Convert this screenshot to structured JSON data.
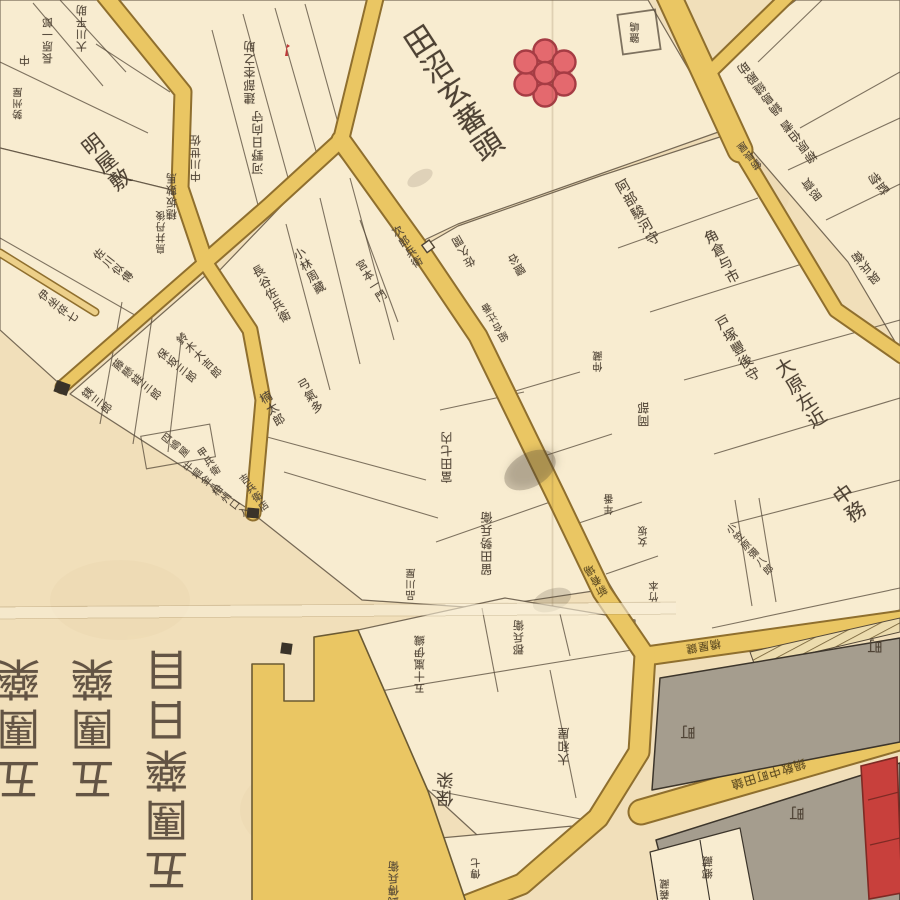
{
  "map": {
    "description": "Edo-period Japanese cadastral block map (kiriezu) with hand-inked parcels, yellow streets, grey townsman blocks and vertical kanji parcel-holder names",
    "palette": {
      "paper": "#f1dfba",
      "parcel": "#f8ecd0",
      "road_fill": "#eac663",
      "road_casing": "#8f6f2e",
      "ink": "#4e4234",
      "street_text": "#5e4b20",
      "gray_block": "#a59d8e",
      "red_mark": "#e4696e",
      "red_building": "#c8403c"
    },
    "marks": [
      {
        "name": "plum-blossom-crest",
        "shape": "seven red circles (one center, six petals)",
        "color": "#e4696e"
      },
      {
        "name": "red-shrine-building",
        "shape": "narrow red rectangle at right edge",
        "color": "#c8403c"
      },
      {
        "name": "guard-post-square",
        "count": 3,
        "color": "#3a3329"
      },
      {
        "name": "road-gate",
        "shape": "small open square on road",
        "color": "#f8ecd0"
      },
      {
        "name": "hatched-bank-strip",
        "shape": "diagonal hatching along street",
        "color": "#6e5a30"
      },
      {
        "name": "small-red-flag",
        "color": "#c03a3a"
      }
    ],
    "big_characters": {
      "note": "large upside-down characters in lower-left blank area",
      "columns": [
        {
          "text": "五團藥",
          "x": 23,
          "y": 727
        },
        {
          "text": "五團藥",
          "x": 97,
          "y": 727
        },
        {
          "text": "五團藥日目",
          "x": 171,
          "y": 768
        }
      ],
      "size": 44,
      "rotation": 180
    },
    "labels": [
      {
        "t": "大川平助",
        "x": 82,
        "y": 28,
        "r": 180,
        "s": 11
      },
      {
        "t": "長原一郎",
        "x": 48,
        "y": 40,
        "r": 180,
        "s": 11
      },
      {
        "t": "中",
        "x": 25,
        "y": 60,
        "r": 180,
        "s": 11
      },
      {
        "t": "勢州屋",
        "x": 20,
        "y": 103,
        "r": 180,
        "s": 10
      },
      {
        "t": "建部杢之助",
        "x": 250,
        "y": 72,
        "r": 180,
        "s": 12
      },
      {
        "t": "河野日向守",
        "x": 258,
        "y": 142,
        "r": 180,
        "s": 12
      },
      {
        "t": "中川世佐",
        "x": 196,
        "y": 158,
        "r": 180,
        "s": 11
      },
      {
        "t": "穗坂數馬",
        "x": 172,
        "y": 196,
        "r": 180,
        "s": 11
      },
      {
        "t": "鳥井丹後",
        "x": 163,
        "y": 232,
        "r": 180,
        "s": 10
      },
      {
        "t": "明屋敷",
        "x": 105,
        "y": 163,
        "r": -38,
        "s": 21
      },
      {
        "t": "佐川似傳",
        "x": 113,
        "y": 266,
        "r": -52,
        "s": 11
      },
      {
        "t": "伊坐倅七",
        "x": 58,
        "y": 307,
        "r": -52,
        "s": 11
      },
      {
        "t": "銕三郎",
        "x": 97,
        "y": 401,
        "r": -52,
        "s": 11
      },
      {
        "t": "藤懸銈三郎",
        "x": 137,
        "y": 380,
        "r": -52,
        "s": 11
      },
      {
        "t": "保坂三郎",
        "x": 177,
        "y": 366,
        "r": -52,
        "s": 11
      },
      {
        "t": "四嶋屋",
        "x": 174,
        "y": 447,
        "r": -52,
        "s": 10
      },
      {
        "t": "牛堀金八",
        "x": 200,
        "y": 479,
        "r": -52,
        "s": 10
      },
      {
        "t": "相州口入",
        "x": 229,
        "y": 503,
        "r": -52,
        "s": 10
      },
      {
        "t": "鈴木大吉郎",
        "x": 199,
        "y": 356,
        "r": -45,
        "s": 11
      },
      {
        "t": "長谷佐兵衛",
        "x": 271,
        "y": 294,
        "r": -30,
        "s": 12
      },
      {
        "t": "小林周藏",
        "x": 309,
        "y": 271,
        "r": -30,
        "s": 12
      },
      {
        "t": "弓氣多",
        "x": 310,
        "y": 396,
        "r": -30,
        "s": 12
      },
      {
        "t": "楠太郎",
        "x": 272,
        "y": 409,
        "r": -30,
        "s": 12
      },
      {
        "t": "甲兵衛",
        "x": 207,
        "y": 463,
        "r": -35,
        "s": 10
      },
      {
        "t": "吉兵衛店",
        "x": 252,
        "y": 494,
        "r": -35,
        "s": 10
      },
      {
        "t": "次郎兵衛",
        "x": 407,
        "y": 247,
        "r": -32,
        "s": 11
      },
      {
        "t": "宮本一門",
        "x": 371,
        "y": 281,
        "r": -32,
        "s": 11
      },
      {
        "t": "田沼玄蕃頭",
        "x": 450,
        "y": 95,
        "r": -33,
        "s": 30
      },
      {
        "t": "鹽嶋",
        "x": 637,
        "y": 32,
        "r": 180,
        "s": 10
      },
      {
        "t": "阿部駿河守",
        "x": 637,
        "y": 213,
        "r": -30,
        "s": 14
      },
      {
        "t": "角倉与市",
        "x": 721,
        "y": 257,
        "r": -28,
        "s": 14
      },
      {
        "t": "戸塚豐後守",
        "x": 737,
        "y": 349,
        "r": -30,
        "s": 14
      },
      {
        "t": "大原左近",
        "x": 799,
        "y": 394,
        "r": -32,
        "s": 19
      },
      {
        "t": "中務",
        "x": 848,
        "y": 504,
        "r": -35,
        "s": 20
      },
      {
        "t": "小笠原彌八郎",
        "x": 748,
        "y": 551,
        "r": -42,
        "s": 10
      },
      {
        "t": "鍋島縫殿助",
        "x": 760,
        "y": 88,
        "r": 142,
        "s": 12
      },
      {
        "t": "柳原伯耆",
        "x": 799,
        "y": 141,
        "r": 142,
        "s": 12
      },
      {
        "t": "錺長屋",
        "x": 751,
        "y": 154,
        "r": 142,
        "s": 10
      },
      {
        "t": "思齊",
        "x": 812,
        "y": 189,
        "r": 142,
        "s": 12
      },
      {
        "t": "監物",
        "x": 879,
        "y": 183,
        "r": 142,
        "s": 12
      },
      {
        "t": "與兵衛",
        "x": 866,
        "y": 267,
        "r": 142,
        "s": 12
      },
      {
        "t": "佐久間",
        "x": 464,
        "y": 251,
        "r": 150,
        "s": 11
      },
      {
        "t": "鹽谷",
        "x": 517,
        "y": 264,
        "r": 150,
        "s": 11
      },
      {
        "t": "組合辻番",
        "x": 497,
        "y": 321,
        "r": 150,
        "s": 10
      },
      {
        "t": "仲藏",
        "x": 600,
        "y": 361,
        "r": 180,
        "s": 10
      },
      {
        "t": "岡部",
        "x": 644,
        "y": 414,
        "r": 180,
        "s": 12
      },
      {
        "t": "留田勢兵衛",
        "x": 487,
        "y": 543,
        "r": 180,
        "s": 12
      },
      {
        "t": "富田七内",
        "x": 447,
        "y": 457,
        "r": 180,
        "s": 12
      },
      {
        "t": "品川屋",
        "x": 413,
        "y": 584,
        "r": 180,
        "s": 10
      },
      {
        "t": "年番",
        "x": 611,
        "y": 504,
        "r": 180,
        "s": 10
      },
      {
        "t": "女坂",
        "x": 645,
        "y": 536,
        "r": 180,
        "s": 10
      },
      {
        "t": "竹本",
        "x": 656,
        "y": 591,
        "r": 180,
        "s": 10
      },
      {
        "t": "新肴場",
        "x": 596,
        "y": 580,
        "r": 150,
        "s": 11,
        "c": "street"
      },
      {
        "t": "五十嵐伊織",
        "x": 420,
        "y": 664,
        "r": 180,
        "s": 11
      },
      {
        "t": "郡兵衛",
        "x": 519,
        "y": 637,
        "r": 180,
        "s": 11
      },
      {
        "t": "保染",
        "x": 448,
        "y": 789,
        "r": 180,
        "s": 17
      },
      {
        "t": "大和屋",
        "x": 564,
        "y": 746,
        "r": 180,
        "s": 12
      },
      {
        "t": "武傳兵衛",
        "x": 394,
        "y": 884,
        "r": 180,
        "s": 11
      },
      {
        "t": "傳七",
        "x": 478,
        "y": 868,
        "r": 180,
        "s": 10
      },
      {
        "t": "郷藏",
        "x": 708,
        "y": 867,
        "r": 180,
        "s": 11
      },
      {
        "t": "義藏",
        "x": 667,
        "y": 889,
        "r": 180,
        "s": 10
      },
      {
        "t": "町",
        "x": 689,
        "y": 732,
        "r": 180,
        "s": 15
      },
      {
        "t": "町",
        "x": 876,
        "y": 646,
        "r": 180,
        "s": 15
      },
      {
        "t": "町",
        "x": 798,
        "y": 813,
        "r": 180,
        "s": 15
      },
      {
        "t": "橋屋鍵",
        "x": 703,
        "y": 646,
        "r": 170,
        "s": 11,
        "c": "street",
        "o": "h"
      },
      {
        "t": "鍋敎中町田鎗",
        "x": 768,
        "y": 774,
        "r": 163,
        "s": 12,
        "c": "street",
        "o": "h"
      }
    ]
  }
}
